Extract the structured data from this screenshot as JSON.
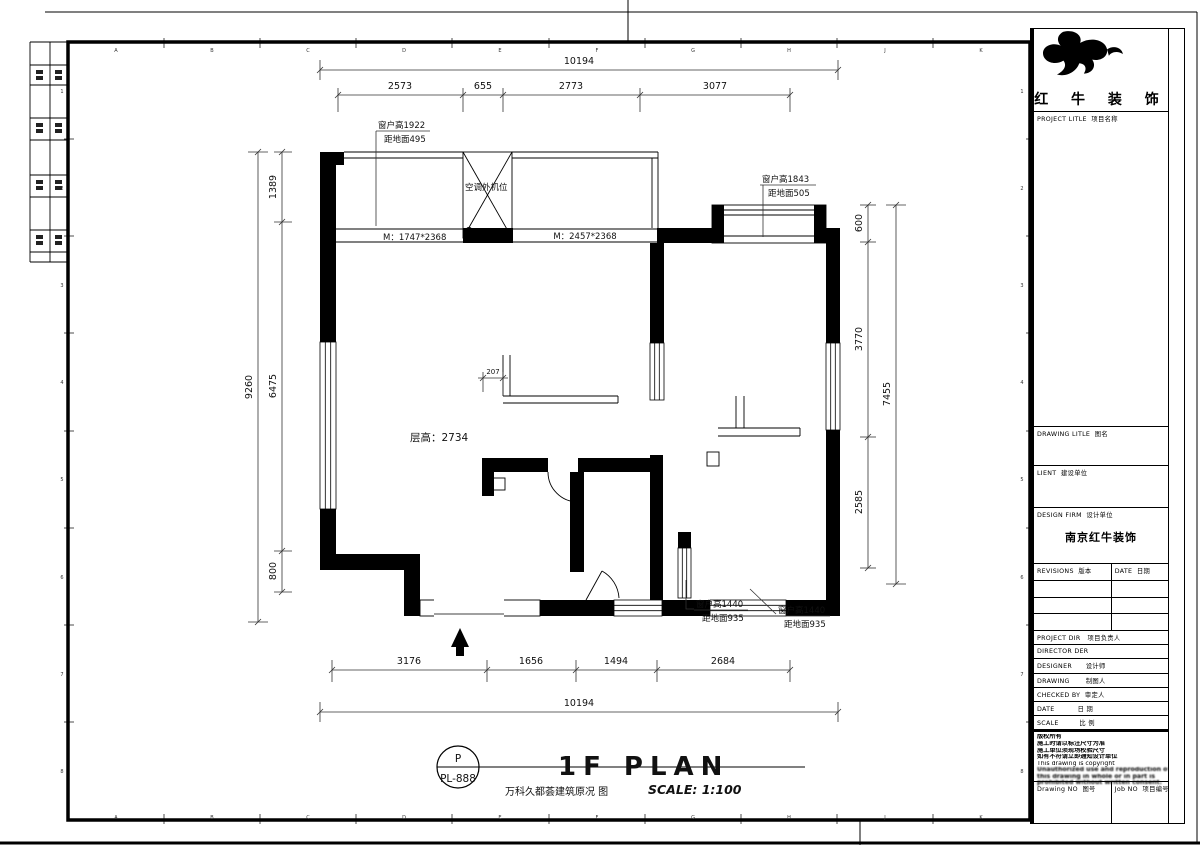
{
  "frame": {
    "top_letters": [
      "A",
      "B",
      "C",
      "D",
      "E",
      "F",
      "G",
      "H",
      "J",
      "K"
    ],
    "bottom_letters": [
      "A",
      "B",
      "C",
      "D",
      "E",
      "F",
      "G",
      "H",
      "J",
      "K"
    ],
    "left_numbers": [
      "1",
      "2",
      "3",
      "4",
      "5",
      "6",
      "7",
      "8"
    ],
    "right_numbers": [
      "1",
      "2",
      "3",
      "4",
      "5",
      "6",
      "7",
      "8"
    ]
  },
  "plan": {
    "dims": {
      "top_total": "10194",
      "top_segments": [
        "2573",
        "655",
        "2773",
        "3077"
      ],
      "left_outer": "9260",
      "left_segments": [
        "1389",
        "6475",
        "800"
      ],
      "right_outer": "7455",
      "right_segments": [
        "600",
        "3770",
        "2585"
      ],
      "bottom_segments": [
        "3176",
        "1656",
        "1494",
        "2684"
      ],
      "bottom_total": "10194",
      "small_offset": "207"
    },
    "labels": {
      "window_tl_line1": "窗户高1922",
      "window_tl_line2": "距地面495",
      "ac_unit": "空调外机位",
      "door_left": "M：1747*2368",
      "door_mid": "M：2457*2368",
      "window_tr_line1": "窗户高1843",
      "window_tr_line2": "距地面505",
      "ceiling_height": "层高：2734",
      "window_b1_line1": "窗户高1440",
      "window_b1_line2": "距地面935",
      "window_b2_line1": "窗户高1440",
      "window_b2_line2": "距地面935"
    },
    "title": {
      "tag_top": "P",
      "tag_code": "PL-888",
      "main": "1F PLAN",
      "sub": "万科久都荟建筑原况 图",
      "scale": "SCALE: 1:100"
    }
  },
  "titleblock": {
    "brand": "红 牛 装 饰",
    "project_title_label": "PROJECT LITLE  项目名称",
    "drawing_title_label": "DRAWING LITLE  图名",
    "client_label": "LIENT  建设单位",
    "design_firm_label": "DESIGN FIRM  设计单位",
    "design_firm_value": "南京红牛装饰",
    "revisions_label": "REVISIONS  版本",
    "date_col_label": "DATE  日期",
    "project_dir_label": "PROJECT DIR   项目负责人",
    "director_label": "DIRECTOR DER",
    "designer_label": "DESIGNER      设计师",
    "drawing_by_label": "DRAWING       制图人",
    "checked_by_label": "CHECKED BY  审定人",
    "date_label": "DATE          日 期",
    "scale_label": "SCALE         比 例",
    "notes": {
      "lines": [
        "版权所有",
        "施工时请以标注尺寸为准",
        "施工单位须现场校验尺寸",
        "如有不符请立即通知设计单位",
        "This drawing is copyright",
        "Unauthorized use and reproduction of",
        "this drawing in whole or in part is",
        "prohibited without written consent."
      ]
    },
    "drawing_no_label": "Drawing NO  图号",
    "job_no_label": "Job NO  项目编号"
  }
}
